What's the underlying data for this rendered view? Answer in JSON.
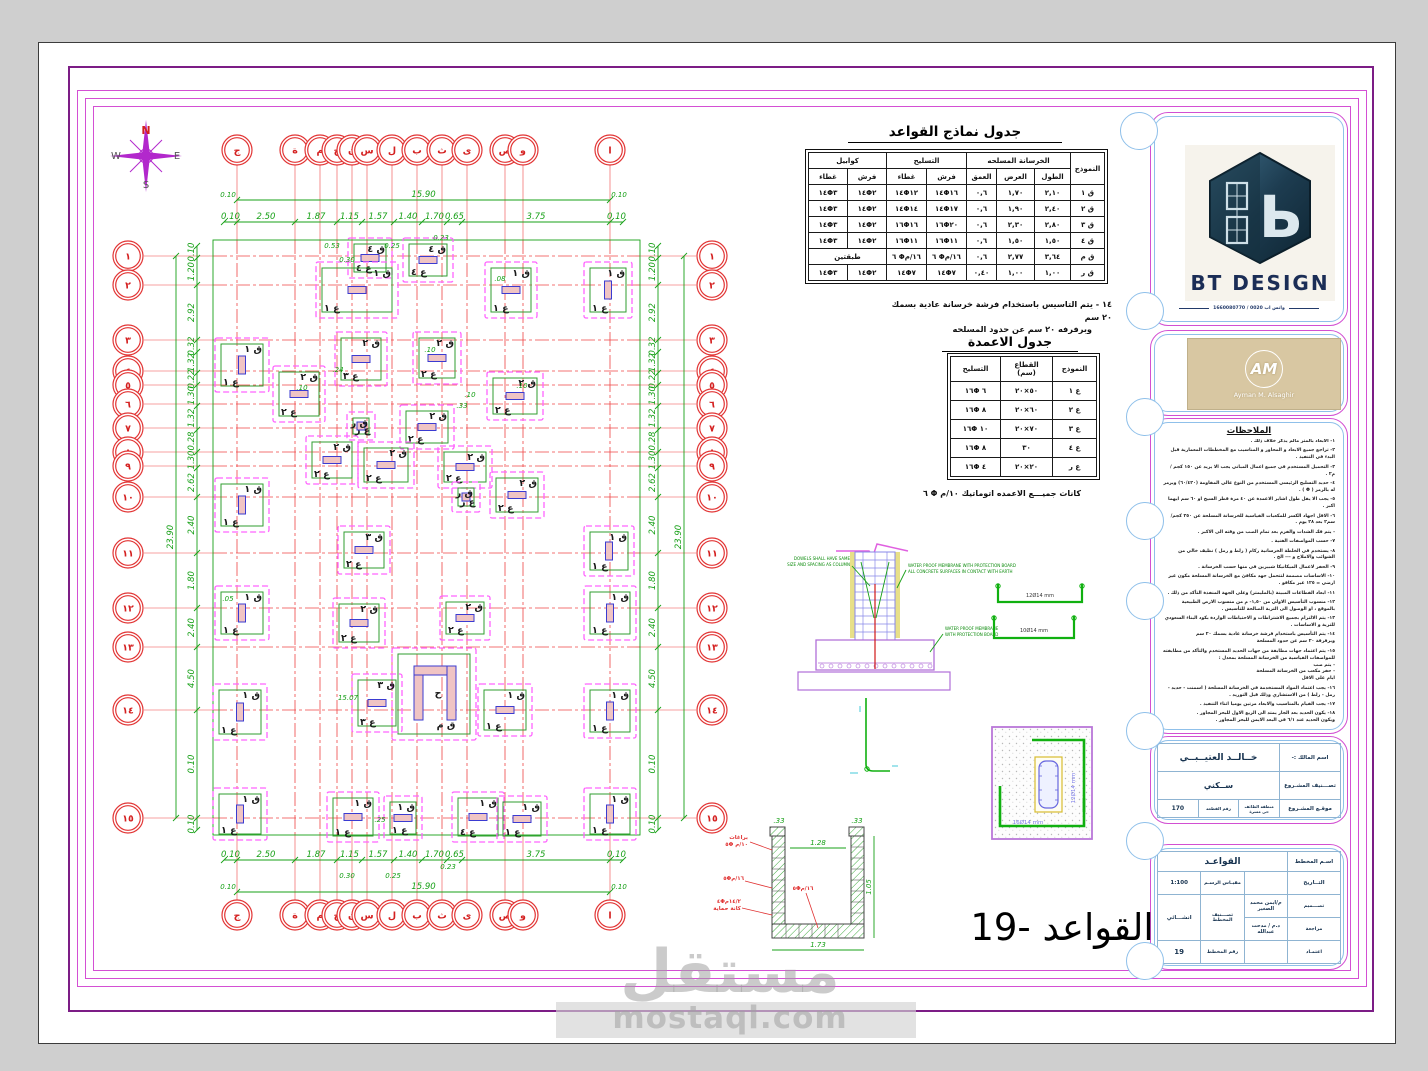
{
  "compass": {
    "n": "N",
    "s": "S",
    "e": "E",
    "w": "W"
  },
  "foundations_table": {
    "title": "جدول نماذج  القواعد",
    "col_model": "النموذج",
    "group_concrete": "الخرسانة المسلحه",
    "group_reinf": "التسليح",
    "group_corbel": "كوابيل",
    "col_length": "الطول",
    "col_width": "العرض",
    "col_depth": "العمق",
    "col_mesh": "فرش",
    "col_cover": "غطاء",
    "two_layers": "طبقتين",
    "rows": [
      [
        "ق ١",
        "٢,١٠",
        "١,٧٠",
        "٠,٦",
        "١٤Φ١٦",
        "١٤Φ١٢",
        "١٤Φ٢",
        "١٤Φ٣"
      ],
      [
        "ق ٢",
        "٢,٤٠",
        "١,٩٠",
        "٠,٦",
        "١٤Φ١٧",
        "١٤Φ١٤",
        "١٤Φ٢",
        "١٤Φ٣"
      ],
      [
        "ق ٣",
        "٢,٨٠",
        "٢,٣٠",
        "٠,٦",
        "١٦Φ٢٠",
        "١٦Φ١٦",
        "١٤Φ٢",
        "١٤Φ٣"
      ],
      [
        "ق ٤",
        "١,٥٠",
        "١,٥٠",
        "٠,٦",
        "١٦Φ١١",
        "١٦Φ١١",
        "١٤Φ٢",
        "١٤Φ٣"
      ],
      [
        "ق م",
        "٣,٦٤",
        "٢,٧٧",
        "٠,٦",
        "٦ Φ١٦/م",
        "٦ Φ١٦/م",
        "طبقتين",
        null
      ],
      [
        "ق ر",
        "١,٠٠",
        "١,٠٠",
        "٠,٤٠",
        "١٤Φ٧",
        "١٤Φ٧",
        "١٤Φ٢",
        "١٤Φ٣"
      ]
    ]
  },
  "note14": {
    "line1": "١٤ -  يتم التاسيس باستخدام فرشة خرسانة عادية بسمك ٢٠ سم",
    "line2": "وبرفرفه ٢٠ سم عن حدود المسلحه"
  },
  "columns_table": {
    "title": "جدول الاعمدة",
    "col_model": "النموذج",
    "section_label": "القطاع",
    "section_unit": "(سم)",
    "col_reinf": "التسليح",
    "rows": [
      [
        "ع ١",
        "٥٠×٢٠",
        "١٦Φ ٦"
      ],
      [
        "ع ٢",
        "٦٠×٢٠",
        "١٦Φ ٨"
      ],
      [
        "ع ٣",
        "٧٠×٢٠",
        "١٦Φ ١٠"
      ],
      [
        "ع ٤",
        "٣٠",
        "١٦Φ ٨"
      ],
      [
        "ع ر",
        "٢٠×٢٠",
        "١٦Φ ٤"
      ]
    ]
  },
  "stirrups_note": {
    "text": "كانات  جميـــع  الاعمده  اتوماتيك",
    "value": "٦ Φ ١٠/م"
  },
  "details": {
    "dowels_1": "DOWELS SHALL HAVE SAME",
    "dowels_2": "SIZE AND SPACING AS COLUMN",
    "wp_top_1": "WATER PROOF MEMBRANE WITH PROTECTION BOARD",
    "wp_top_2": "ALL CONCRETE SURFACES IN CONTACT WITH EARTH",
    "wp_bot_1": "WATER PROOF MEMBRANE",
    "wp_bot_2": "WITH PROTECTION BOARD",
    "ubar_1": "12Ø14 mm",
    "ubar_2": "10Ø14 mm",
    "colplan_1": "16Ø14 mm",
    "colplan_2": "12Ø14 mm",
    "tank_label_1": "براغات",
    "tank_label_1b": "٥Φ ١٠/م",
    "tank_label_2": "٥Φ١٦/م",
    "tank_label_3": "٤Φ١٤/٢م",
    "tank_label_3b": "كانة حماية",
    "tank_label_4": "٥Φ١٦/م",
    "tank_dim_w": "1.73",
    "tank_dim_h": "1.05",
    "tank_dim_in": "1.28",
    "tank_dim_t1": ".33",
    "tank_dim_t2": ".33"
  },
  "plan": {
    "grid_cols": [
      {
        "x": 237,
        "l": "ج"
      },
      {
        "x": 295,
        "l": "ة"
      },
      {
        "x": 320,
        "l": "م"
      },
      {
        "x": 337,
        "l": "خ"
      },
      {
        "x": 352,
        "l": "ن"
      },
      {
        "x": 367,
        "l": "س"
      },
      {
        "x": 392,
        "l": "ل"
      },
      {
        "x": 417,
        "l": "ب"
      },
      {
        "x": 442,
        "l": "ث"
      },
      {
        "x": 467,
        "l": "ى"
      },
      {
        "x": 505,
        "l": "ص"
      },
      {
        "x": 523,
        "l": "و"
      },
      {
        "x": 610,
        "l": "ا"
      }
    ],
    "grid_rows": [
      {
        "y": 256,
        "l": "١"
      },
      {
        "y": 285,
        "l": "٢"
      },
      {
        "y": 340,
        "l": "٣"
      },
      {
        "y": 371,
        "l": "٤"
      },
      {
        "y": 385,
        "l": "٥"
      },
      {
        "y": 404,
        "l": "٦"
      },
      {
        "y": 428,
        "l": "٧"
      },
      {
        "y": 452,
        "l": "٨"
      },
      {
        "y": 466,
        "l": "٩"
      },
      {
        "y": 497,
        "l": "١٠"
      },
      {
        "y": 553,
        "l": "١١"
      },
      {
        "y": 608,
        "l": "١٢"
      },
      {
        "y": 647,
        "l": "١٣"
      },
      {
        "y": 710,
        "l": "١٤"
      },
      {
        "y": 818,
        "l": "١٥"
      }
    ],
    "pads": [
      [
        348,
        238,
        44,
        40,
        "ق ٤",
        "ع ٤"
      ],
      [
        403,
        238,
        50,
        44,
        "ق ٤",
        "ع ٤"
      ],
      [
        316,
        262,
        82,
        56,
        "ق ١",
        "ع ١"
      ],
      [
        485,
        262,
        52,
        56,
        "ق ١",
        "ع ١"
      ],
      [
        584,
        262,
        48,
        56,
        "ق ١",
        "ع ١"
      ],
      [
        215,
        338,
        54,
        54,
        "ق ١",
        "ع ١"
      ],
      [
        273,
        366,
        52,
        56,
        "ق ٢",
        "ع ٢"
      ],
      [
        335,
        332,
        52,
        54,
        "ق ٢",
        "ع ٣"
      ],
      [
        413,
        332,
        48,
        52,
        "ق ٢",
        "ع ٢"
      ],
      [
        487,
        372,
        56,
        48,
        "ق ٢",
        "ع ٢"
      ],
      [
        347,
        412,
        28,
        28,
        "ق ر",
        "ع ر"
      ],
      [
        400,
        405,
        54,
        44,
        "ق ٢",
        "ع ٢"
      ],
      [
        306,
        436,
        52,
        48,
        "ق ٢",
        "ع ٢"
      ],
      [
        358,
        442,
        56,
        46,
        "ق ٢",
        "ع ٢"
      ],
      [
        438,
        446,
        54,
        42,
        "ق ٢",
        "ع ٢"
      ],
      [
        452,
        482,
        28,
        30,
        "ق ر",
        "ع ر"
      ],
      [
        490,
        472,
        54,
        46,
        "ق ٢",
        "ع ٢"
      ],
      [
        215,
        478,
        54,
        54,
        "ق ١",
        "ع ١"
      ],
      [
        338,
        526,
        52,
        48,
        "ق ٣",
        "ع ٢"
      ],
      [
        584,
        526,
        50,
        50,
        "ق ١",
        "ع ١"
      ],
      [
        215,
        586,
        54,
        54,
        "ق ١",
        "ع ١"
      ],
      [
        333,
        598,
        52,
        50,
        "ق ٢",
        "ع ٢"
      ],
      [
        440,
        596,
        50,
        44,
        "ق ٢",
        "ع ٢"
      ],
      [
        584,
        586,
        52,
        54,
        "ق ١",
        "ع ١"
      ],
      [
        392,
        648,
        84,
        92,
        "ق م",
        "ح"
      ],
      [
        352,
        674,
        50,
        58,
        "ق ٣",
        "ع ٣"
      ],
      [
        213,
        684,
        54,
        56,
        "ق ١",
        "ع ١"
      ],
      [
        478,
        684,
        54,
        52,
        "ق ١",
        "ع ١"
      ],
      [
        584,
        684,
        52,
        54,
        "ق ١",
        "ع ١"
      ],
      [
        213,
        788,
        54,
        52,
        "ق ١",
        "ع ١"
      ],
      [
        327,
        792,
        52,
        50,
        "ق ١",
        "ع ١"
      ],
      [
        384,
        796,
        38,
        44,
        "ق ١",
        "ع ١"
      ],
      [
        452,
        792,
        52,
        50,
        "ق ١",
        "ع ٤"
      ],
      [
        497,
        796,
        50,
        46,
        "ق ١",
        "ع ١"
      ],
      [
        584,
        788,
        52,
        52,
        "ق ١",
        "ع ١"
      ]
    ],
    "dims": {
      "top": {
        "y": 222,
        "b": [
          224,
          237,
          295,
          337,
          362,
          394,
          422,
          447,
          462,
          610,
          623
        ],
        "labels": [
          "0.10",
          "2.50",
          "1.87",
          "1.15",
          "1.57",
          "1.40",
          "1.70",
          "0.65",
          "3.75",
          "0.10"
        ]
      },
      "bottom": {
        "y": 860,
        "b": [
          224,
          237,
          295,
          337,
          362,
          394,
          422,
          447,
          462,
          610,
          623
        ],
        "labels": [
          "0.10",
          "2.50",
          "1.87",
          "1.15",
          "1.57",
          "1.40",
          "1.70",
          "0.65",
          "3.75",
          "0.10"
        ]
      },
      "left": {
        "x": 197,
        "b": [
          246,
          258,
          285,
          340,
          352,
          373,
          385,
          406,
          430,
          452,
          468,
          497,
          553,
          608,
          647,
          710,
          818,
          830
        ],
        "labels": [
          "0.10",
          "1.20",
          "2.92",
          "0.32",
          "1.32",
          "0.22",
          "1.30",
          "1.32",
          "0.28",
          "1.30",
          "2.62",
          "2.40",
          "1.80",
          "2.40",
          "4.50",
          "0.10",
          "0.10"
        ]
      },
      "right": {
        "x": 658,
        "b": [
          246,
          258,
          285,
          340,
          352,
          373,
          385,
          406,
          430,
          452,
          468,
          497,
          553,
          608,
          647,
          710,
          818,
          830
        ],
        "labels": [
          "0.10",
          "1.20",
          "2.92",
          "0.32",
          "1.32",
          "0.22",
          "1.30",
          "1.32",
          "0.28",
          "1.30",
          "2.62",
          "2.40",
          "1.80",
          "2.40",
          "4.50",
          "0.10",
          "0.10"
        ]
      },
      "top_total": {
        "y": 200,
        "a": 237,
        "c": 610,
        "label": "15.90"
      },
      "bottom_total": {
        "y": 892,
        "a": 237,
        "c": 610,
        "label": "15.90"
      },
      "left_total": {
        "x": 176,
        "a": 256,
        "c": 818,
        "label": "23.90"
      },
      "right_total": {
        "x": 684,
        "a": 256,
        "c": 818,
        "label": "23.90"
      },
      "extras": [
        [
          332,
          248,
          "0.53"
        ],
        [
          347,
          262,
          "0.30"
        ],
        [
          392,
          248,
          "0.25"
        ],
        [
          441,
          240,
          "0.23"
        ],
        [
          347,
          878,
          "0.30"
        ],
        [
          393,
          878,
          "0.25"
        ],
        [
          448,
          869,
          "0.23"
        ],
        [
          228,
          197,
          "0.10"
        ],
        [
          619,
          197,
          "0.10"
        ],
        [
          228,
          889,
          "0.10"
        ],
        [
          619,
          889,
          "0.10"
        ],
        [
          500,
          281,
          ".08"
        ],
        [
          430,
          352,
          ".10"
        ],
        [
          338,
          372,
          ".24"
        ],
        [
          470,
          397,
          ".10"
        ],
        [
          462,
          408,
          ".33"
        ],
        [
          348,
          700,
          "15.07"
        ],
        [
          228,
          601,
          ".05"
        ],
        [
          380,
          822,
          ".25"
        ],
        [
          522,
          388,
          ".10"
        ],
        [
          302,
          390,
          ".10"
        ]
      ]
    }
  },
  "branding": {
    "bt_name": "BT DESIGN",
    "bt_phone": "واتس اب 0020 / 1660080770",
    "am_initials": "AM",
    "am_name": "Ayman M. Alsaghir"
  },
  "notes_panel": {
    "title": "الملاحظات",
    "notes": [
      "١- الابعاد بالمتر مالم يذكر خلاف ذلك .",
      "٢- تراجع جميع الابعاد و المحاور و المناسيب مع المخططات المعمارية قبل البدء في التنفيذ .",
      "٣- التحميل المستخدم في جميع اعمال المباني يجب الا يزيد عن ١٥٠ كجم / م٢ .",
      "٤- حديد التسليح الرئيسي المستخدم من النوع عالي المقاومة (٦٠/٤٢٠) ويرمز له بالرمز ( Φ ) .",
      "٥- يجب الا يقل طول اشاير الاعمدة عن ٤٠ مرة قطر السيخ او ٦٠ سم ايهما اكبر .",
      "٦- الاقل اجهاد الكسر للمكعبات القياسية للخرسانة المسلحة عن ٢٥٠ كجم/سم٢ بعد ٢٨ يوم .",
      "- يتم فك الشدات والفرم بعد تمام الصب من وقته الى الاكبر .",
      "٧- حسب المواصفات الفنية .",
      "٨- يستخدم في الخلطة الخرسانية ركام ( زلط و رمل ) نظيف خالي من الشوائب والاملاح و --- الخ .",
      "٩- الحفر لاعمال الميكانيكا شبيرين في منها حسب الخرسانة .",
      "١٠- الاساسات مصممة لتتحمل جهد مكافئ مع الخرسانة المسلحة مكون غير ارضي = ١٢٥ غير مكافو .",
      "١١- ابعاد القطاعات المبينة (بالمليمتر) وعلى الجهة المنفذة التأكد من ذلك .",
      "١٢- منسوب التأسيس الاولي من ١,٥٠- م من منسوب الارض الطبيعية بالموقع ، او الوصول الى التربة الصالحة للتأسيس .",
      "١٣- يتم الالتزام بجميع الاشتراطات و الاحتياطات الواردة بكود البناء السعودي للتربة و الاساسات .",
      "١٤- يتم التأسيس باستخدام فرشة خرسانة عادية بسمك ٢٠ سم\nوبرفرفة ٢٠ سم عن حدود المسلحة",
      "١٥- يتم اعتماد جهات مطابقة من جهات الحديد المستخدم والتأكد من مطابقته للمواصفات القياسية من الخرسانة المسلحة بمعدل :\n- يتم صب\n- حفر مكعب من الخرسانة المسلحة\nايام على الاقل",
      "١٦- يجب اعتماد المواد المستخدمة في الخرسانة المسلحة ( اسمنت - حديد - رمل - زلط ) من الاستشاري وذلك قبل التوريد .",
      "١٧- يجب القيام بالمناسيب والابعاد مرتين يوميا اثناء التنفيذ .",
      "١٨- يكون الحديد بعد الجار يمتد الى الربع الاول للبحر المجاور .\nويكون الحديد عند ٦/١ في البعد الايمن للبحر المجاور .",
      "١٩- تتم مراجعة الاشتراطات الخاصة لمقاومة الزلازل .",
      "٢٠- يفضل عمل شفاطات في منسوب القواعد ٨٠-٧٠ لتغطيتها قبل الصب مع حفل طبيعي ومغلي .",
      "٢١- ارتفاع المبنى لا يزيد عن ١٥ مترا فوق ميدان المبنى و لا يتم زيادة ميدان المبنى .",
      "٢٢- يتم عزل الاساسات عزلا جيدا وذلك بعد الدهان  من المبنى ."
    ]
  },
  "title_block": {
    "owner_label": "اسم المالك :-",
    "owner": "خــالــد العتيــبــي",
    "class_label": "تصـــنيف المشـروع",
    "class_value": "ســكني",
    "loc_label": "موقـع المشـروع",
    "loc_value": "منطقة الطائف\nحي مسرة",
    "parcel_label": "رقم القطعة",
    "parcel": "170",
    "plan_name_label": "اسـم المخطط",
    "plan_name": "القواعـد",
    "date_label": "التــاريخ",
    "scale_label": "مقيـاس الرسـم",
    "scale": "1:100",
    "design_label": "تصـــميم",
    "designer": "م/ايمن محمد الصغير",
    "review_label": "مراجعة",
    "reviewer": "د.م / مدحت عبدالله",
    "approve_label": "اعتمـاد",
    "plan_class_label": "تصـــنيف المخطط",
    "plan_class": "انشـــائي",
    "plan_no_label": "رقم المخطط",
    "plan_no": "19"
  },
  "main_title": "19- القواعد",
  "watermark": {
    "ar": "مستقل",
    "en": "mostaql.com"
  }
}
